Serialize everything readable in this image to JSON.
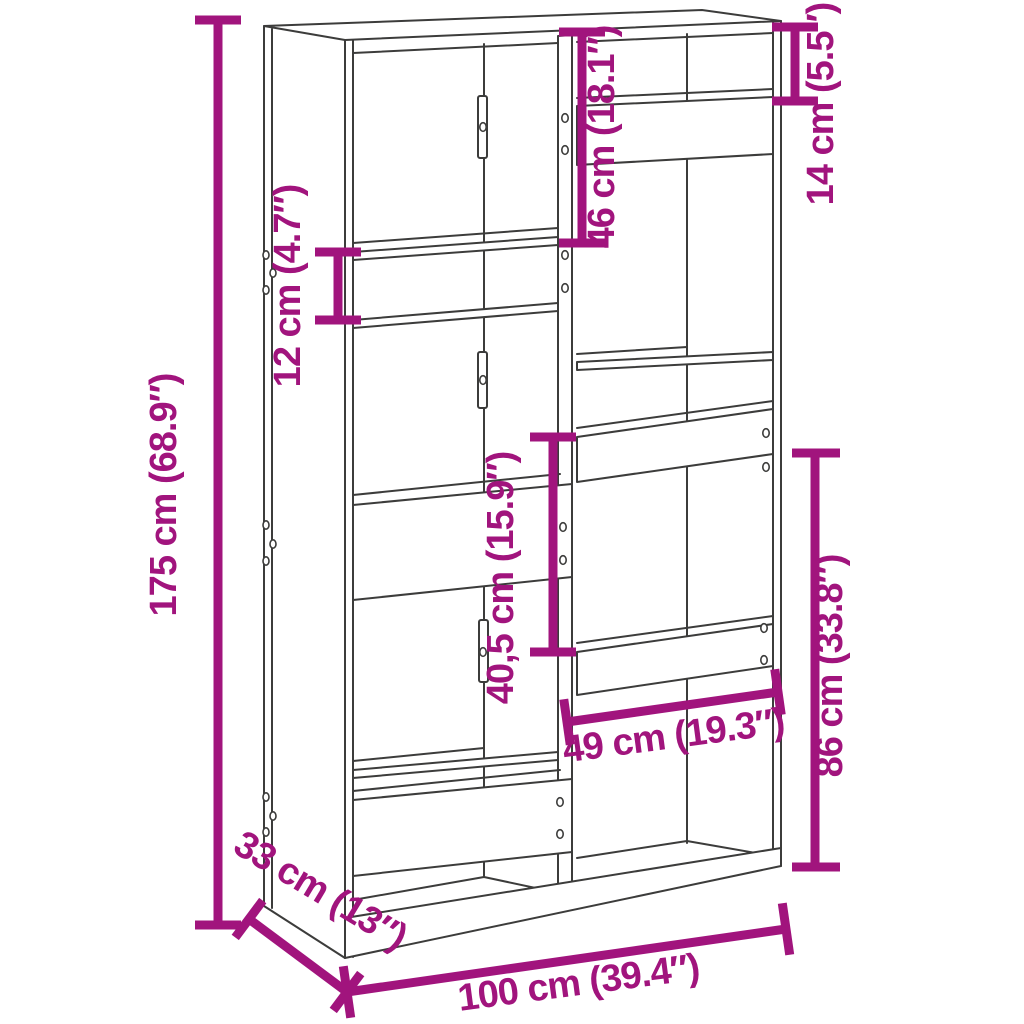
{
  "figure": {
    "type": "product-dimension-diagram",
    "subject": "bookcase room-divider line drawing with staggered compartments",
    "background_color": "#ffffff"
  },
  "colors": {
    "dimension_accent": "#A1147D",
    "drawing_line": "#3C3C3B"
  },
  "dimensions": {
    "height": {
      "label": "175 cm (68.9″)"
    },
    "top_left_opening": {
      "label": "46 cm (18.1″)"
    },
    "top_right_slot": {
      "label": "14 cm (5.5″)"
    },
    "left_slot": {
      "label": "12 cm (4.7″)"
    },
    "middle_right_opening": {
      "label": "40,5 cm (15.9″)"
    },
    "bottom_right_width": {
      "label": "49 cm (19.3″)"
    },
    "bottom_right_height": {
      "label": "86 cm (33.8″)"
    },
    "depth": {
      "label": "33 cm (13″)"
    },
    "width": {
      "label": "100 cm (39.4″)"
    }
  }
}
